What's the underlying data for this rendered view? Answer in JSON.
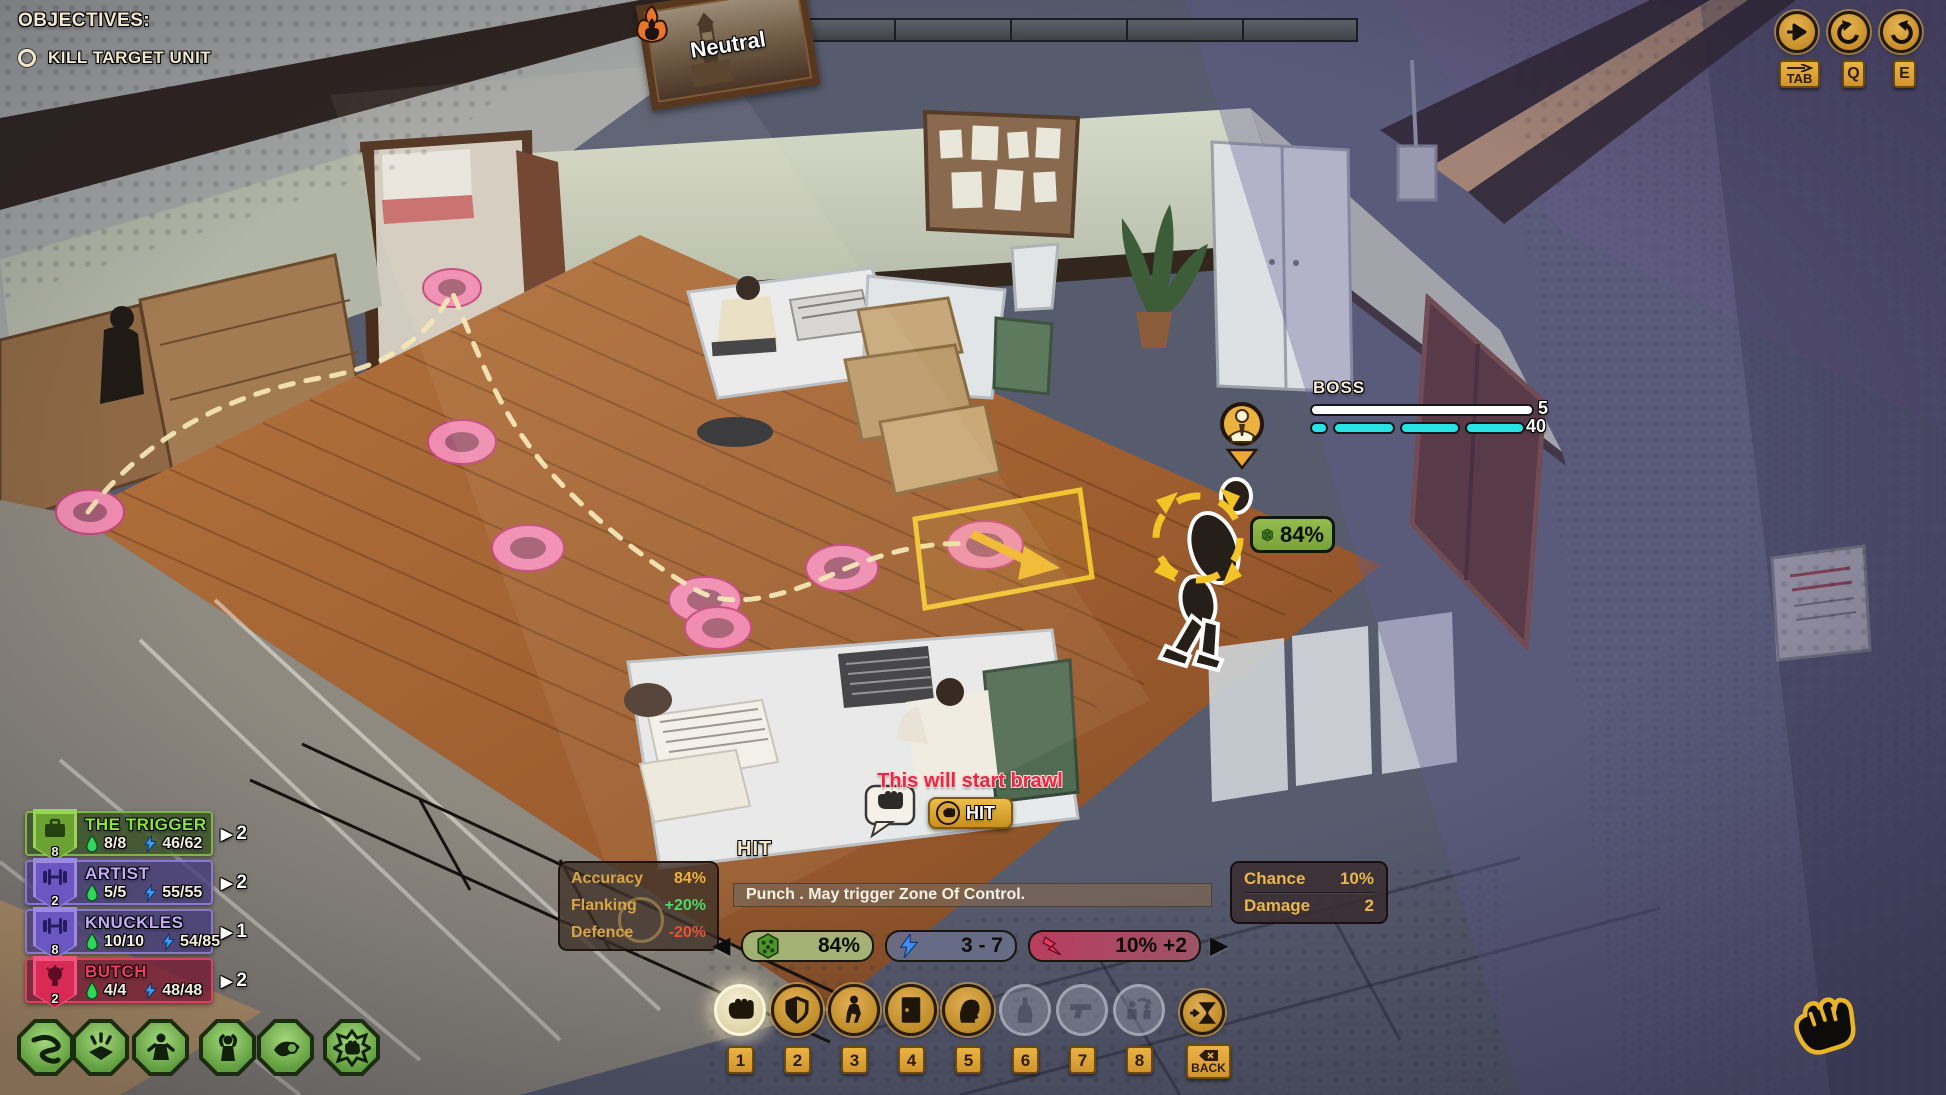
{
  "objectives": {
    "title": "OBJECTIVES:",
    "goal": "KILL TARGET UNIT"
  },
  "heat": {
    "state_label": "Neutral"
  },
  "camera": {
    "pan_key": "TAB",
    "rotate_left_key": "Q",
    "rotate_right_key": "E"
  },
  "boss": {
    "name": "BOSS",
    "health": "5",
    "stamina": "40",
    "health_color": "#ffffff",
    "stamina_color": "#27e3e3"
  },
  "world": {
    "hit_chance_badge": "84%"
  },
  "brawl": {
    "warning": "This will start brawl",
    "hit_label": "HIT"
  },
  "combat": {
    "title": "HIT",
    "modifiers": [
      {
        "label": "Accuracy",
        "value": "84%"
      },
      {
        "label": "Flanking",
        "value": "+20%"
      },
      {
        "label": "Defence",
        "value": "-20%"
      }
    ],
    "description": "Punch . May trigger Zone Of Control.",
    "pills": [
      {
        "icon": "dice-icon",
        "value": "84%"
      },
      {
        "icon": "lightning-icon",
        "value": "3 - 7"
      },
      {
        "icon": "strike-icon",
        "value": "10% +2"
      }
    ],
    "details": [
      {
        "label": "Chance",
        "value": "10%"
      },
      {
        "label": "Damage",
        "value": "2"
      }
    ]
  },
  "squad": {
    "members": [
      {
        "name": "THE TRIGGER",
        "level": "8",
        "hp": "8/8",
        "energy": "46/62",
        "actions": "2",
        "icon": "briefcase-icon",
        "theme": "green"
      },
      {
        "name": "ARTIST",
        "level": "2",
        "hp": "5/5",
        "energy": "55/55",
        "actions": "2",
        "icon": "dumbbell-icon",
        "theme": "purple"
      },
      {
        "name": "KNUCKLES",
        "level": "8",
        "hp": "10/10",
        "energy": "54/85",
        "actions": "1",
        "icon": "dumbbell-icon",
        "theme": "purple"
      },
      {
        "name": "BUTCH",
        "level": "2",
        "hp": "4/4",
        "energy": "48/48",
        "actions": "2",
        "icon": "lightbulb-icon",
        "theme": "red"
      }
    ]
  },
  "ability_badges": [
    {
      "icon": "snake-icon"
    },
    {
      "icon": "ambush-icon"
    },
    {
      "icon": "persuade-icon"
    },
    {
      "icon": "surrender-icon"
    },
    {
      "icon": "bribe-icon"
    },
    {
      "icon": "brawl-icon"
    }
  ],
  "action_bar": {
    "slots": [
      {
        "key": "1",
        "icon": "fist-icon",
        "state": "selected"
      },
      {
        "key": "2",
        "icon": "shield-icon",
        "state": "active"
      },
      {
        "key": "3",
        "icon": "sneak-icon",
        "state": "active"
      },
      {
        "key": "4",
        "icon": "door-icon",
        "state": "active"
      },
      {
        "key": "5",
        "icon": "head-icon",
        "state": "active"
      },
      {
        "key": "6",
        "icon": "bottle-icon",
        "state": "disabled"
      },
      {
        "key": "7",
        "icon": "pistol-icon",
        "state": "disabled"
      },
      {
        "key": "8",
        "icon": "swap-icon",
        "state": "disabled"
      }
    ],
    "end_turn_key": "BACK"
  },
  "colors": {
    "accent_gold": "#e2a33c",
    "squad_green": "#8ae63e",
    "squad_purple": "#c3abfa",
    "squad_red": "#f23b63",
    "pill_green": "#a7bb7c",
    "pill_blue": "#686e88",
    "pill_red": "#be3c5c",
    "hp_green": "#2ed65a",
    "energy_blue": "#3b9cf5"
  }
}
